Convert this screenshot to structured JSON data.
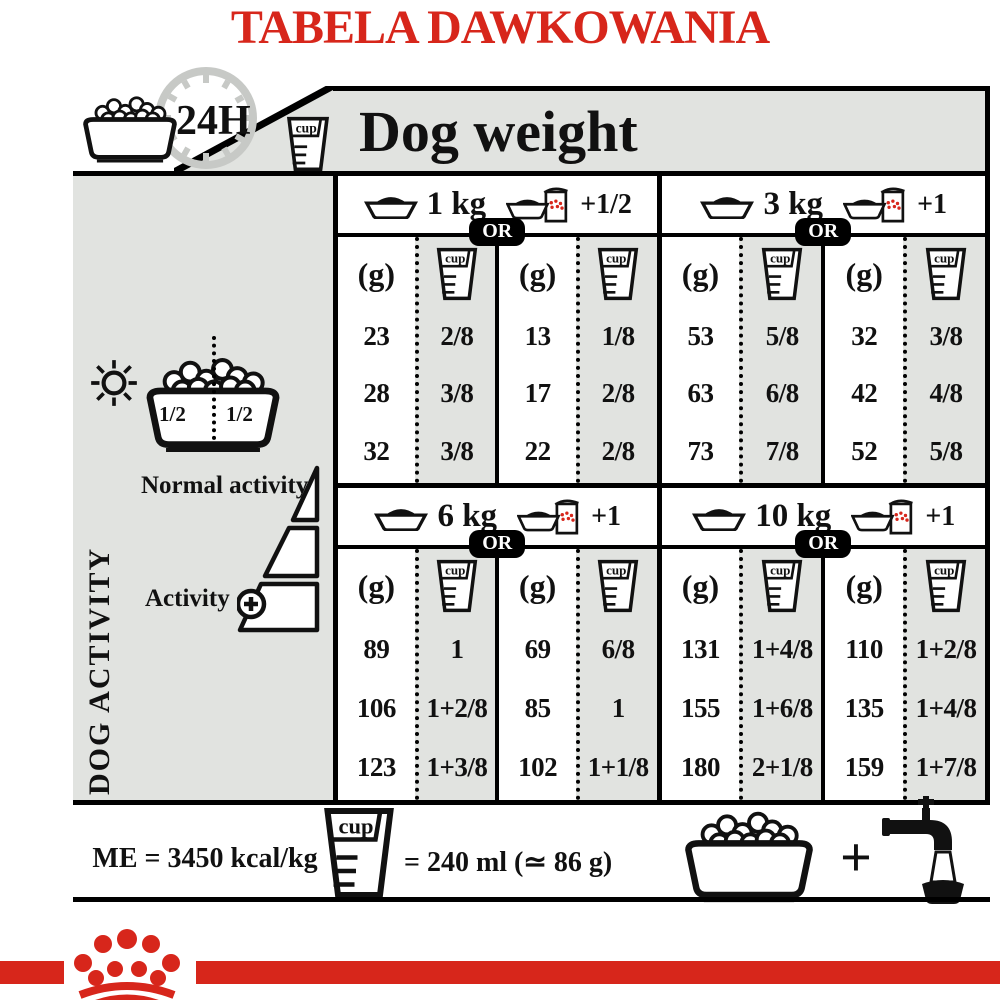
{
  "title": "TABELA DAWKOWANIA",
  "header": {
    "hours_label": "24H",
    "cup_label": "cup",
    "dog_weight_label": "Dog weight"
  },
  "sidebar": {
    "bowl_half_left": "1/2",
    "bowl_half_right": "1/2",
    "vertical_label": "DOG ACTIVITY",
    "normal_activity_label": "Normal activity",
    "activity_label": "Activity"
  },
  "table": {
    "or_label": "OR",
    "gram_header": "(g)",
    "cup_header": "cup",
    "sections": [
      {
        "weight": "1 kg",
        "pouch_qty": "+1/2",
        "kibble_only": {
          "grams": [
            "23",
            "28",
            "32"
          ],
          "cups": [
            "2/8",
            "3/8",
            "3/8"
          ]
        },
        "with_pouch": {
          "grams": [
            "13",
            "17",
            "22"
          ],
          "cups": [
            "1/8",
            "2/8",
            "2/8"
          ]
        }
      },
      {
        "weight": "3 kg",
        "pouch_qty": "+1",
        "kibble_only": {
          "grams": [
            "53",
            "63",
            "73"
          ],
          "cups": [
            "5/8",
            "6/8",
            "7/8"
          ]
        },
        "with_pouch": {
          "grams": [
            "32",
            "42",
            "52"
          ],
          "cups": [
            "3/8",
            "4/8",
            "5/8"
          ]
        }
      },
      {
        "weight": "6 kg",
        "pouch_qty": "+1",
        "kibble_only": {
          "grams": [
            "89",
            "106",
            "123"
          ],
          "cups": [
            "1",
            "1+2/8",
            "1+3/8"
          ]
        },
        "with_pouch": {
          "grams": [
            "69",
            "85",
            "102"
          ],
          "cups": [
            "6/8",
            "1",
            "1+1/8"
          ]
        }
      },
      {
        "weight": "10 kg",
        "pouch_qty": "+1",
        "kibble_only": {
          "grams": [
            "131",
            "155",
            "180"
          ],
          "cups": [
            "1+4/8",
            "1+6/8",
            "2+1/8"
          ]
        },
        "with_pouch": {
          "grams": [
            "110",
            "135",
            "159"
          ],
          "cups": [
            "1+2/8",
            "1+4/8",
            "1+7/8"
          ]
        }
      }
    ]
  },
  "footer": {
    "energy_label": "ME = 3450 kcal/kg",
    "cup_label": "cup",
    "cup_equivalence": "= 240 ml (≃ 86 g)",
    "plus_sign": "+"
  },
  "colors": {
    "brand_red": "#d7261b",
    "panel_gray": "#e1e3e0"
  }
}
